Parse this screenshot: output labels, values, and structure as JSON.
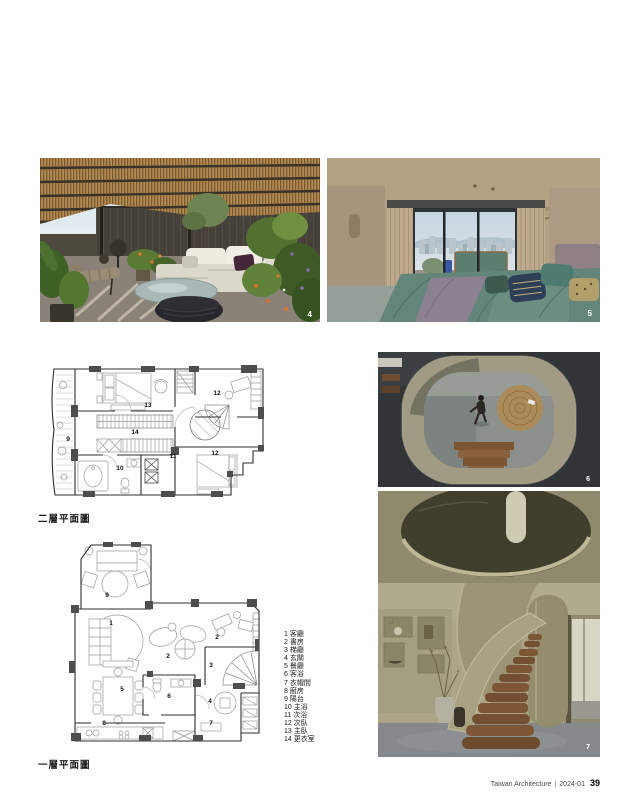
{
  "page": {
    "background": "#ffffff",
    "footer": {
      "journal": "Taiwan Architecture",
      "separator": "|",
      "issue": "2024-01",
      "page_number": "39"
    }
  },
  "photos": {
    "terrace": {
      "number": "4"
    },
    "bedroom": {
      "number": "5"
    },
    "void": {
      "number": "6"
    },
    "stair": {
      "number": "7"
    }
  },
  "plans": {
    "f2": {
      "caption": "二層平面圖",
      "numbers": [
        "13",
        "12",
        "14",
        "9",
        "10",
        "11",
        "12"
      ]
    },
    "f1": {
      "caption": "一層平面圖",
      "numbers": [
        "9",
        "1",
        "2",
        "2",
        "3",
        "5",
        "6",
        "4",
        "8",
        "7"
      ]
    }
  },
  "legend": {
    "items": [
      "1 客廳",
      "2 書房",
      "3 梯廳",
      "4 玄關",
      "5 餐廳",
      "6 客浴",
      "7 衣帽間",
      "8 廚房",
      "9 陽台",
      "10 主浴",
      "11 次浴",
      "12 次臥",
      "13 主臥",
      "14 更衣室"
    ]
  },
  "colors": {
    "caption_text": "#1a1a1a",
    "footer_text": "#4a4a4a",
    "photo_number": "#ffffff"
  }
}
